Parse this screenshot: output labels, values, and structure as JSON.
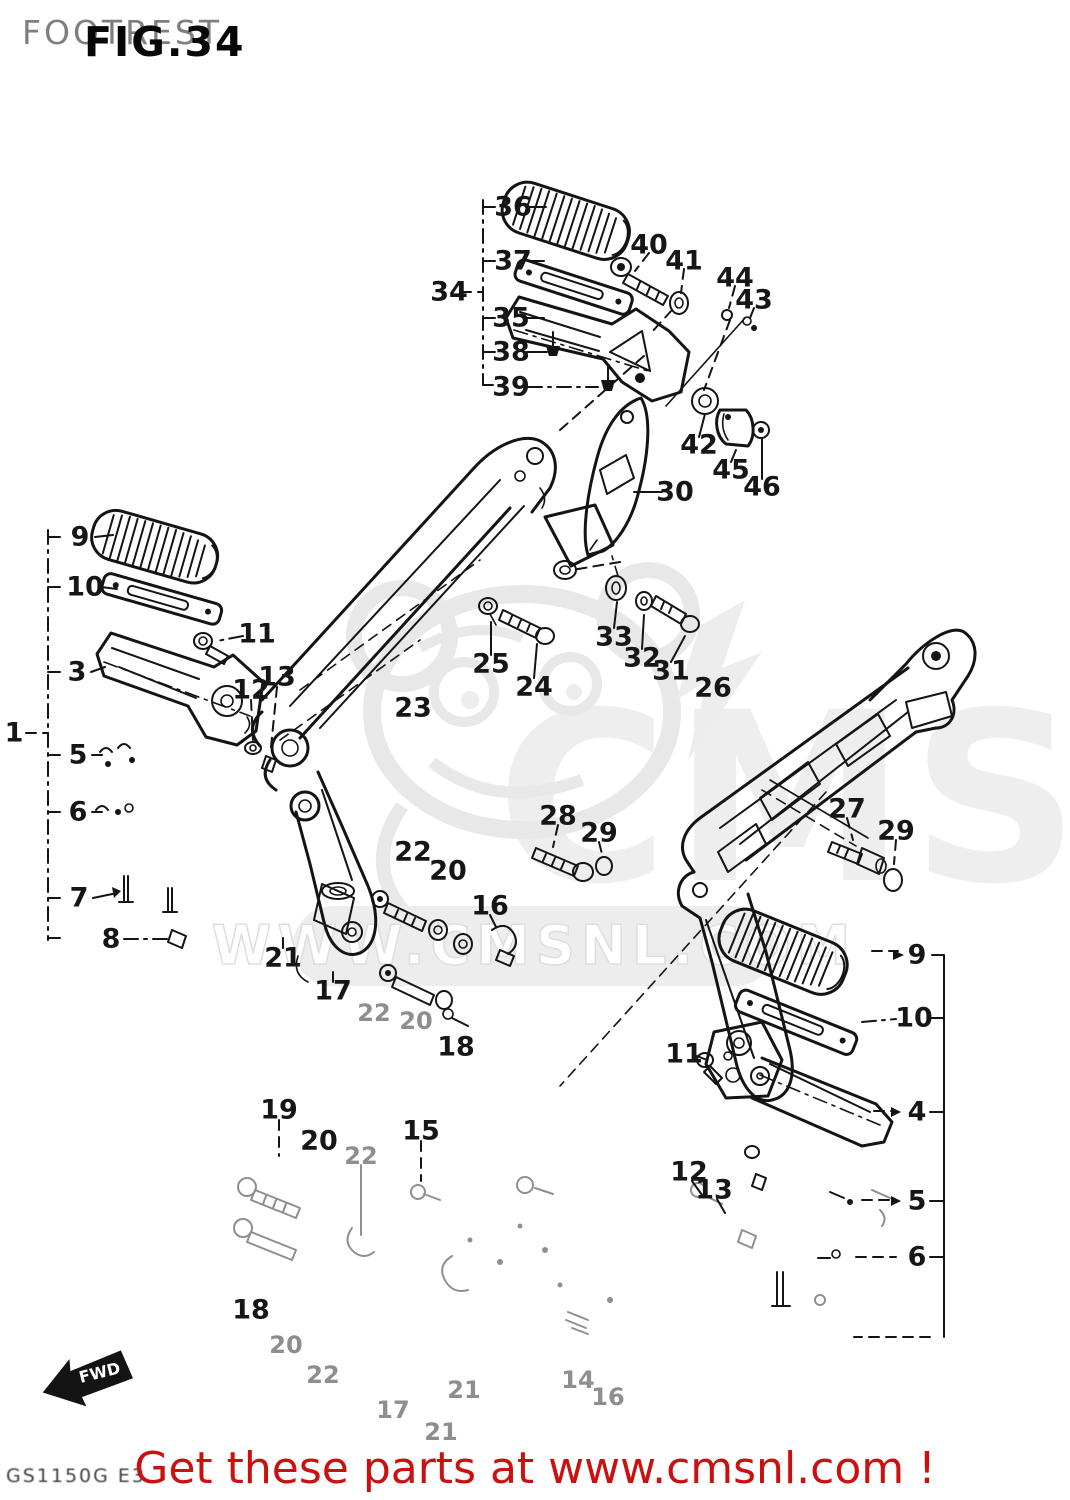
{
  "header": {
    "title": "FOOTREST",
    "figure": "FIG.34"
  },
  "watermark": {
    "logo": "CMS",
    "site": "WWW.CMSNL.COM"
  },
  "footer": {
    "promo": "Get these parts at www.cmsnl.com !",
    "model_code": "GS1150G E3"
  },
  "fwd_badge": {
    "label": "FWD"
  },
  "colors": {
    "promo_red": "#cc1010",
    "line_ink": "#141414",
    "faint_ink": "#8f8f8f",
    "header_gray": "#7f7f7f",
    "watermark_gray": "#e8e8e8"
  },
  "part_labels": [
    {
      "n": "36",
      "x": 513,
      "y": 207
    },
    {
      "n": "37",
      "x": 513,
      "y": 261
    },
    {
      "n": "34",
      "x": 449,
      "y": 292
    },
    {
      "n": "35",
      "x": 511,
      "y": 318
    },
    {
      "n": "38",
      "x": 511,
      "y": 352
    },
    {
      "n": "39",
      "x": 511,
      "y": 387
    },
    {
      "n": "40",
      "x": 649,
      "y": 245
    },
    {
      "n": "41",
      "x": 684,
      "y": 261
    },
    {
      "n": "44",
      "x": 735,
      "y": 278
    },
    {
      "n": "43",
      "x": 754,
      "y": 300
    },
    {
      "n": "42",
      "x": 699,
      "y": 445
    },
    {
      "n": "45",
      "x": 731,
      "y": 470
    },
    {
      "n": "46",
      "x": 762,
      "y": 487
    },
    {
      "n": "30",
      "x": 675,
      "y": 492
    },
    {
      "n": "9",
      "x": 80,
      "y": 537
    },
    {
      "n": "10",
      "x": 85,
      "y": 587
    },
    {
      "n": "11",
      "x": 257,
      "y": 634
    },
    {
      "n": "3",
      "x": 77,
      "y": 672
    },
    {
      "n": "1",
      "x": 14,
      "y": 733
    },
    {
      "n": "13",
      "x": 277,
      "y": 677
    },
    {
      "n": "12",
      "x": 251,
      "y": 690
    },
    {
      "n": "5",
      "x": 78,
      "y": 755
    },
    {
      "n": "6",
      "x": 78,
      "y": 812
    },
    {
      "n": "7",
      "x": 79,
      "y": 898
    },
    {
      "n": "8",
      "x": 111,
      "y": 939
    },
    {
      "n": "23",
      "x": 413,
      "y": 708
    },
    {
      "n": "25",
      "x": 491,
      "y": 664
    },
    {
      "n": "24",
      "x": 534,
      "y": 687
    },
    {
      "n": "33",
      "x": 614,
      "y": 637
    },
    {
      "n": "32",
      "x": 642,
      "y": 658
    },
    {
      "n": "31",
      "x": 671,
      "y": 671
    },
    {
      "n": "26",
      "x": 713,
      "y": 688
    },
    {
      "n": "28",
      "x": 558,
      "y": 816
    },
    {
      "n": "29",
      "x": 599,
      "y": 833
    },
    {
      "n": "22",
      "x": 413,
      "y": 852
    },
    {
      "n": "20",
      "x": 448,
      "y": 871
    },
    {
      "n": "16",
      "x": 490,
      "y": 906
    },
    {
      "n": "21",
      "x": 283,
      "y": 958
    },
    {
      "n": "17",
      "x": 333,
      "y": 991
    },
    {
      "n": "22",
      "x": 374,
      "y": 1013,
      "f": true
    },
    {
      "n": "20",
      "x": 416,
      "y": 1021,
      "f": true
    },
    {
      "n": "18",
      "x": 456,
      "y": 1047
    },
    {
      "n": "27",
      "x": 847,
      "y": 809
    },
    {
      "n": "29",
      "x": 896,
      "y": 831
    },
    {
      "n": "9",
      "x": 917,
      "y": 955
    },
    {
      "n": "10",
      "x": 914,
      "y": 1018
    },
    {
      "n": "11",
      "x": 684,
      "y": 1054
    },
    {
      "n": "4",
      "x": 917,
      "y": 1112
    },
    {
      "n": "12",
      "x": 689,
      "y": 1172
    },
    {
      "n": "13",
      "x": 714,
      "y": 1190
    },
    {
      "n": "5",
      "x": 917,
      "y": 1201
    },
    {
      "n": "6",
      "x": 917,
      "y": 1257
    },
    {
      "n": "19",
      "x": 279,
      "y": 1110
    },
    {
      "n": "20",
      "x": 319,
      "y": 1141
    },
    {
      "n": "22",
      "x": 361,
      "y": 1156,
      "f": true
    },
    {
      "n": "15",
      "x": 421,
      "y": 1131
    },
    {
      "n": "18",
      "x": 251,
      "y": 1310
    },
    {
      "n": "20",
      "x": 286,
      "y": 1345,
      "f": true
    },
    {
      "n": "22",
      "x": 323,
      "y": 1375,
      "f": true
    },
    {
      "n": "17",
      "x": 393,
      "y": 1410,
      "f": true
    },
    {
      "n": "21",
      "x": 464,
      "y": 1390,
      "f": true
    },
    {
      "n": "21",
      "x": 441,
      "y": 1432,
      "f": true
    },
    {
      "n": "14",
      "x": 578,
      "y": 1380,
      "f": true
    },
    {
      "n": "16",
      "x": 608,
      "y": 1397,
      "f": true
    }
  ]
}
